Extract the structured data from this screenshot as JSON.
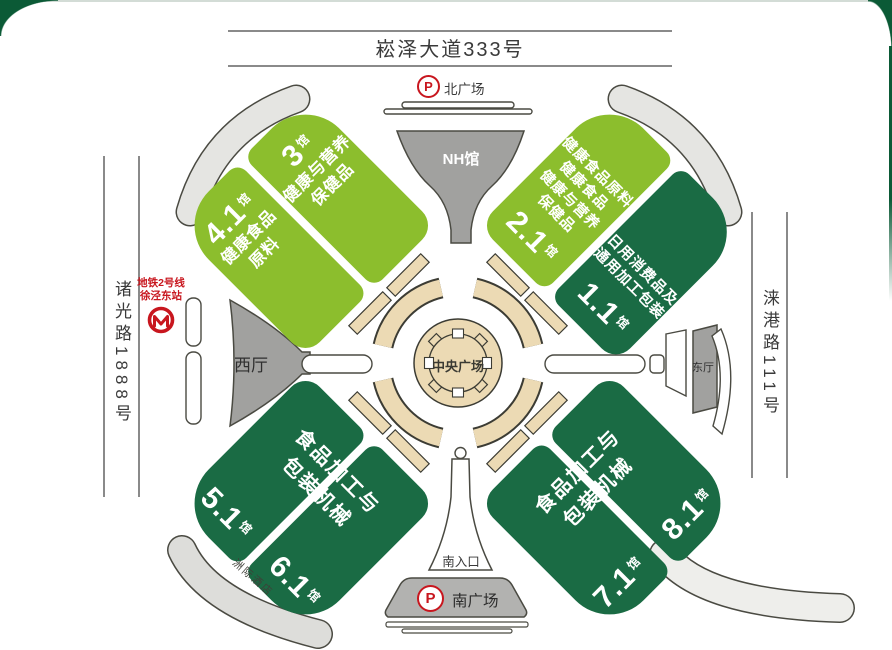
{
  "title": "展馆平面图",
  "colors": {
    "hall_light_green": "#8CBE2D",
    "hall_dark_green": "#1A6B44",
    "frame_green": "#0B5A36",
    "plaza_tan": "#ECDAB4",
    "building_gray": "#A1A19F",
    "accent_red": "#C8161E"
  },
  "roads": {
    "north": {
      "label": "崧泽大道333号"
    },
    "west": {
      "label": "诸光路1888号"
    },
    "east": {
      "label": "涞港路111号"
    }
  },
  "metro": {
    "line1": "地铁2号线",
    "line2": "徐泾东站",
    "logo": "shanghai-metro-icon"
  },
  "plazas": {
    "north": {
      "label": "北广场",
      "parking": "P"
    },
    "south": {
      "label": "南广场",
      "parking": "P"
    },
    "central": {
      "label": "中央广场"
    }
  },
  "buildings": {
    "nh_hall": {
      "label": "NH馆"
    },
    "west_hall": {
      "label": "西厅"
    },
    "east_hall": {
      "label": "东厅"
    },
    "south_entrance": {
      "label": "南入口"
    },
    "hotel": {
      "label": "洲际酒店"
    }
  },
  "halls": {
    "h3": {
      "num": "3",
      "suffix": "馆",
      "lines": [
        "健康与营养",
        "保健品"
      ]
    },
    "h4_1": {
      "num": "4.1",
      "suffix": "馆",
      "lines": [
        "健康食品",
        "原料"
      ]
    },
    "h2_1": {
      "num": "2.1",
      "suffix": "馆",
      "lines": [
        "健康食品原料",
        "健康食品",
        "健康与营养",
        "保健品"
      ]
    },
    "h1_1": {
      "num": "1.1",
      "suffix": "馆",
      "lines": [
        "日用消费品及",
        "通用加工包装"
      ]
    },
    "h5_1": {
      "num": "5.1",
      "suffix": "馆"
    },
    "h6_1": {
      "num": "6.1",
      "suffix": "馆"
    },
    "h7_1": {
      "num": "7.1",
      "suffix": "馆"
    },
    "h8_1": {
      "num": "8.1",
      "suffix": "馆"
    },
    "southwest_text": {
      "line1": "食品加工与",
      "line2": "包装机械"
    },
    "southeast_text": {
      "line1": "食品加工与",
      "line2": "包装机械"
    }
  }
}
